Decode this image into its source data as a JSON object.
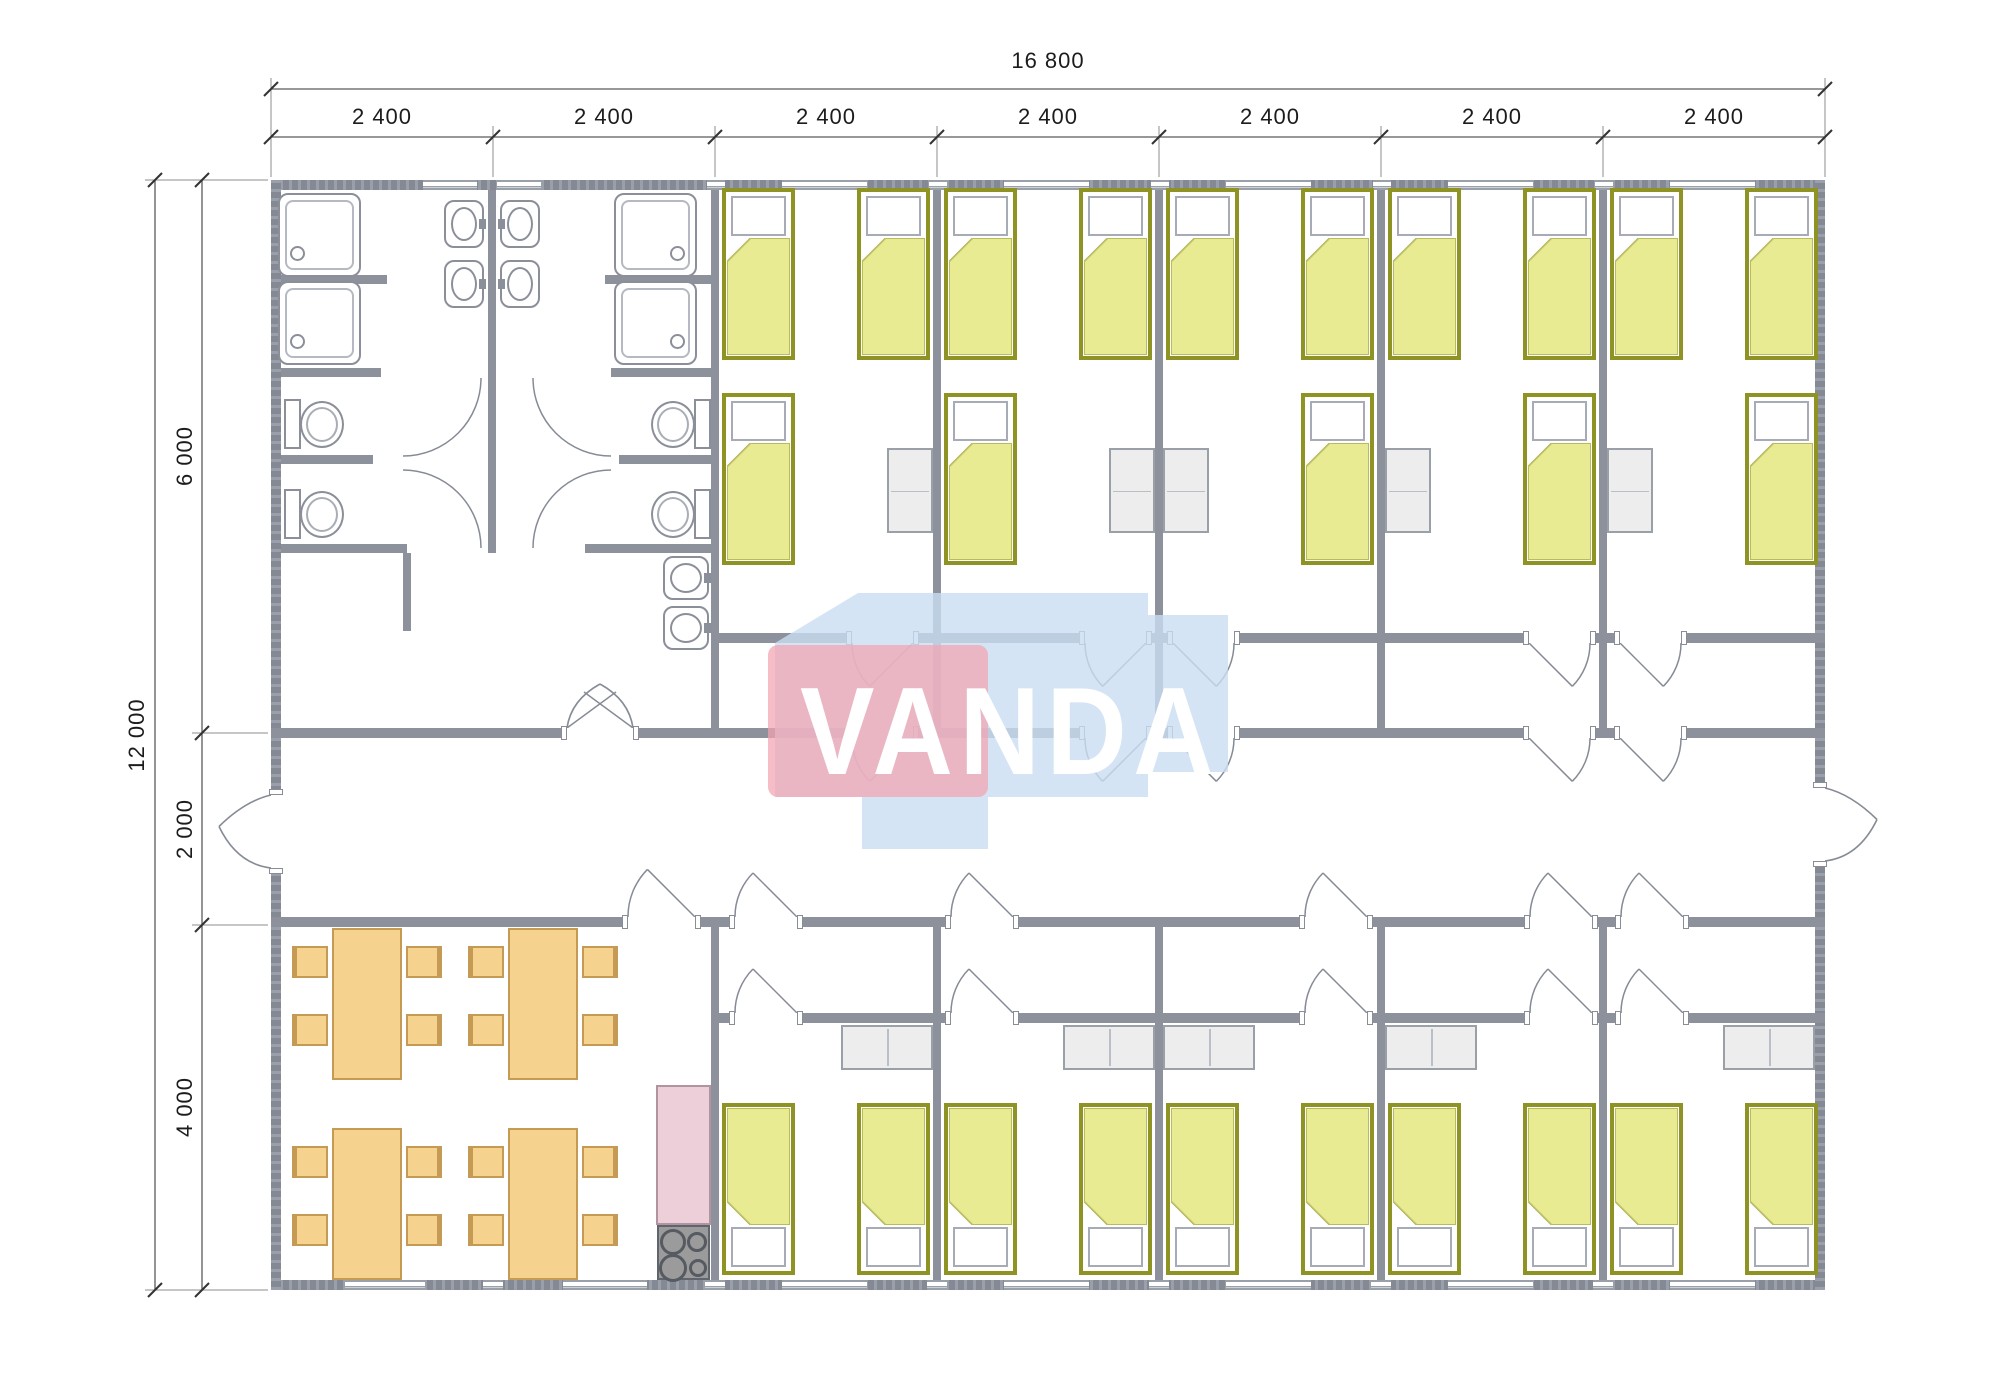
{
  "canvas": {
    "width": 2000,
    "height": 1391,
    "background": "#ffffff"
  },
  "watermark": {
    "text": "VANDA",
    "pink_color": "rgba(242,164,178,0.72)",
    "blue_color": "rgba(201,221,241,0.80)",
    "text_color": "#ffffff",
    "blue_polygon": "775,643 858,593 1148,593 1148,615 1228,615 1228,772 1148,772 1148,797 988,797 988,849 862,849 862,797 775,797"
  },
  "dimensions": {
    "top_total": "16 800",
    "top_modules": [
      "2 400",
      "2 400",
      "2 400",
      "2 400",
      "2 400",
      "2 400",
      "2 400"
    ],
    "left_total": "12 000",
    "left_segments": [
      "6 000",
      "2 000",
      "4 000"
    ],
    "geometry": {
      "lines": [
        [
          271,
          89,
          1825,
          89
        ],
        [
          271,
          137,
          1825,
          137
        ],
        [
          155,
          180,
          155,
          1290
        ],
        [
          202,
          180,
          202,
          1290
        ]
      ],
      "ticks": [
        [
          271,
          89
        ],
        [
          1825,
          89
        ],
        [
          271,
          137
        ],
        [
          493,
          137
        ],
        [
          715,
          137
        ],
        [
          937,
          137
        ],
        [
          1159,
          137
        ],
        [
          1381,
          137
        ],
        [
          1603,
          137
        ],
        [
          1825,
          137
        ],
        [
          155,
          180
        ],
        [
          155,
          1290
        ],
        [
          202,
          180
        ],
        [
          202,
          733
        ],
        [
          202,
          925
        ],
        [
          202,
          1290
        ]
      ],
      "extensions": [
        [
          271,
          78,
          271,
          177
        ],
        [
          1825,
          78,
          1825,
          177
        ],
        [
          493,
          126,
          493,
          177
        ],
        [
          715,
          126,
          715,
          177
        ],
        [
          937,
          126,
          937,
          177
        ],
        [
          1159,
          126,
          1159,
          177
        ],
        [
          1381,
          126,
          1381,
          177
        ],
        [
          1603,
          126,
          1603,
          177
        ],
        [
          145,
          180,
          268,
          180
        ],
        [
          145,
          1290,
          268,
          1290
        ],
        [
          192,
          733,
          268,
          733
        ],
        [
          192,
          925,
          268,
          925
        ]
      ],
      "module_label_centers": [
        382,
        604,
        826,
        1048,
        1270,
        1492,
        1714
      ],
      "module_label_y": 104,
      "total_label": {
        "cx": 1048,
        "y": 48
      },
      "left_total_center": {
        "cx": 137,
        "cy": 735
      },
      "left_segment_centers": [
        456,
        829,
        1107
      ],
      "left_segment_x": 185
    }
  },
  "plan": {
    "colors": {
      "wall": "#8d919c",
      "bed_border": "#8e9323",
      "bed_fill": "#e9eb92",
      "furniture_wood": "#f5d28e",
      "wood_border": "#c49a55",
      "wardrobe": "#ededed",
      "counter": "#eccfd8",
      "stove": "#9b9b9b",
      "fixture_stroke": "#8a8f99",
      "dim_color": "#1c1c1c"
    },
    "walls": [
      [
        271,
        180,
        1554,
        10,
        "hx"
      ],
      [
        271,
        1280,
        1554,
        10,
        "hx"
      ],
      [
        271,
        180,
        10,
        1110,
        "hy"
      ],
      [
        1815,
        180,
        10,
        1110,
        "hy"
      ],
      [
        271,
        728,
        1554,
        10,
        ""
      ],
      [
        271,
        917,
        1554,
        10,
        ""
      ],
      [
        715,
        633,
        1110,
        10,
        ""
      ],
      [
        715,
        1013,
        1110,
        10,
        ""
      ],
      [
        711,
        190,
        8,
        538,
        ""
      ],
      [
        711,
        927,
        8,
        353,
        ""
      ],
      [
        933,
        190,
        8,
        548,
        ""
      ],
      [
        1155,
        190,
        8,
        548,
        ""
      ],
      [
        1377,
        190,
        8,
        548,
        ""
      ],
      [
        1599,
        190,
        8,
        548,
        ""
      ],
      [
        933,
        927,
        8,
        353,
        ""
      ],
      [
        1155,
        927,
        8,
        353,
        ""
      ],
      [
        1377,
        927,
        8,
        353,
        ""
      ],
      [
        1599,
        927,
        8,
        353,
        ""
      ],
      [
        488,
        190,
        8,
        363,
        ""
      ],
      [
        281,
        275,
        106,
        9,
        ""
      ],
      [
        281,
        368,
        100,
        9,
        ""
      ],
      [
        281,
        455,
        92,
        9,
        ""
      ],
      [
        281,
        544,
        126,
        9,
        ""
      ],
      [
        605,
        275,
        106,
        9,
        ""
      ],
      [
        611,
        368,
        100,
        9,
        ""
      ],
      [
        619,
        455,
        92,
        9,
        ""
      ],
      [
        585,
        544,
        126,
        9,
        ""
      ],
      [
        403,
        553,
        8,
        78,
        ""
      ]
    ],
    "windows": [
      [
        423,
        180,
        54
      ],
      [
        497,
        180,
        44
      ],
      [
        782,
        180,
        85
      ],
      [
        1004,
        180,
        85
      ],
      [
        1226,
        180,
        85
      ],
      [
        1448,
        180,
        85
      ],
      [
        1670,
        180,
        85
      ],
      [
        707,
        180,
        18
      ],
      [
        929,
        180,
        18
      ],
      [
        1151,
        180,
        18
      ],
      [
        1373,
        180,
        18
      ],
      [
        1595,
        180,
        18
      ],
      [
        345,
        1280,
        80
      ],
      [
        563,
        1280,
        84
      ],
      [
        782,
        1280,
        85
      ],
      [
        1004,
        1280,
        85
      ],
      [
        1226,
        1280,
        85
      ],
      [
        1448,
        1280,
        85
      ],
      [
        1670,
        1280,
        85
      ],
      [
        483,
        1280,
        20
      ],
      [
        705,
        1280,
        20
      ],
      [
        927,
        1280,
        20
      ],
      [
        1149,
        1280,
        20
      ],
      [
        1371,
        1280,
        20
      ],
      [
        1593,
        1280,
        20
      ]
    ],
    "doors": [
      {
        "type": "dbl",
        "x": 567,
        "y": 728,
        "w": 66
      },
      {
        "type": "q",
        "x": 628,
        "y": 917,
        "w": 67,
        "dir": -1,
        "hinge": "r"
      },
      {
        "type": "q",
        "x": 852,
        "y": 633,
        "w": 61,
        "dir": 1,
        "hinge": "r"
      },
      {
        "type": "q",
        "x": 1085,
        "y": 633,
        "w": 61,
        "dir": 1,
        "hinge": "r"
      },
      {
        "type": "q",
        "x": 1173,
        "y": 633,
        "w": 61,
        "dir": 1,
        "hinge": "l"
      },
      {
        "type": "q",
        "x": 1529,
        "y": 633,
        "w": 61,
        "dir": 1,
        "hinge": "l"
      },
      {
        "type": "q",
        "x": 1620,
        "y": 633,
        "w": 61,
        "dir": 1,
        "hinge": "l"
      },
      {
        "type": "q",
        "x": 852,
        "y": 728,
        "w": 61,
        "dir": 1,
        "hinge": "r"
      },
      {
        "type": "q",
        "x": 1085,
        "y": 728,
        "w": 61,
        "dir": 1,
        "hinge": "r"
      },
      {
        "type": "q",
        "x": 1173,
        "y": 728,
        "w": 61,
        "dir": 1,
        "hinge": "l"
      },
      {
        "type": "q",
        "x": 1529,
        "y": 728,
        "w": 61,
        "dir": 1,
        "hinge": "l"
      },
      {
        "type": "q",
        "x": 1620,
        "y": 728,
        "w": 61,
        "dir": 1,
        "hinge": "l"
      },
      {
        "type": "q",
        "x": 735,
        "y": 917,
        "w": 62,
        "dir": -1,
        "hinge": "r"
      },
      {
        "type": "q",
        "x": 951,
        "y": 917,
        "w": 62,
        "dir": -1,
        "hinge": "r"
      },
      {
        "type": "q",
        "x": 1305,
        "y": 917,
        "w": 62,
        "dir": -1,
        "hinge": "r"
      },
      {
        "type": "q",
        "x": 1530,
        "y": 917,
        "w": 62,
        "dir": -1,
        "hinge": "r"
      },
      {
        "type": "q",
        "x": 1621,
        "y": 917,
        "w": 62,
        "dir": -1,
        "hinge": "r"
      },
      {
        "type": "q",
        "x": 735,
        "y": 1013,
        "w": 62,
        "dir": -1,
        "hinge": "r"
      },
      {
        "type": "q",
        "x": 951,
        "y": 1013,
        "w": 62,
        "dir": -1,
        "hinge": "r"
      },
      {
        "type": "q",
        "x": 1305,
        "y": 1013,
        "w": 62,
        "dir": -1,
        "hinge": "r"
      },
      {
        "type": "q",
        "x": 1530,
        "y": 1013,
        "w": 62,
        "dir": -1,
        "hinge": "r"
      },
      {
        "type": "q",
        "x": 1621,
        "y": 1013,
        "w": 62,
        "dir": -1,
        "hinge": "r"
      },
      {
        "type": "entry",
        "side": "l",
        "y": 795,
        "w": 73
      },
      {
        "type": "entry",
        "side": "r",
        "y": 788,
        "w": 73
      }
    ],
    "extra_arcs": [
      "M403,456 A78,78 0 0 0 481,378",
      "M533,378 A78,78 0 0 0 611,456",
      "M481,548 A78,78 0 0 0 403,470",
      "M611,470 A78,78 0 0 0 533,548"
    ],
    "beds": {
      "size": [
        73,
        172
      ],
      "north": [
        [
          722,
          188
        ],
        [
          857,
          188
        ],
        [
          944,
          188
        ],
        [
          1079,
          188
        ],
        [
          1166,
          188
        ],
        [
          1301,
          188
        ],
        [
          1388,
          188
        ],
        [
          1523,
          188
        ],
        [
          1610,
          188
        ],
        [
          1745,
          188
        ],
        [
          722,
          393
        ],
        [
          944,
          393
        ],
        [
          1301,
          393
        ],
        [
          1523,
          393
        ],
        [
          1745,
          393
        ]
      ],
      "south": [
        [
          722,
          1103
        ],
        [
          857,
          1103
        ],
        [
          944,
          1103
        ],
        [
          1079,
          1103
        ],
        [
          1166,
          1103
        ],
        [
          1301,
          1103
        ],
        [
          1388,
          1103
        ],
        [
          1523,
          1103
        ],
        [
          1610,
          1103
        ],
        [
          1745,
          1103
        ]
      ]
    },
    "wardrobes": {
      "vertical": {
        "size": [
          46,
          85
        ],
        "pos": [
          [
            887,
            448
          ],
          [
            1109,
            448
          ],
          [
            1163,
            448
          ],
          [
            1385,
            448
          ],
          [
            1607,
            448
          ]
        ]
      },
      "horizontal": {
        "size": [
          92,
          45
        ],
        "pos": [
          [
            841,
            1025
          ],
          [
            1063,
            1025
          ],
          [
            1163,
            1025
          ],
          [
            1385,
            1025
          ],
          [
            1723,
            1025
          ]
        ]
      }
    },
    "showers": {
      "size": [
        83,
        84
      ],
      "pos": [
        [
          278,
          193,
          "bl"
        ],
        [
          278,
          281,
          "bl"
        ],
        [
          614,
          193,
          "br"
        ],
        [
          614,
          281,
          "br"
        ]
      ]
    },
    "toilets": [
      [
        284,
        396,
        "r"
      ],
      [
        284,
        486,
        "r"
      ],
      [
        649,
        396,
        "l"
      ],
      [
        649,
        486,
        "l"
      ]
    ],
    "sinks": [
      [
        444,
        200,
        40,
        48,
        "r"
      ],
      [
        444,
        260,
        40,
        48,
        "r"
      ],
      [
        500,
        200,
        40,
        48,
        "l"
      ],
      [
        500,
        260,
        40,
        48,
        "l"
      ],
      [
        663,
        556,
        46,
        44,
        "r"
      ],
      [
        663,
        606,
        46,
        44,
        "r"
      ]
    ],
    "dining": {
      "table_size": [
        70,
        152
      ],
      "tables": [
        [
          332,
          928
        ],
        [
          508,
          928
        ],
        [
          332,
          1128
        ],
        [
          508,
          1128
        ]
      ],
      "chair_size": [
        36,
        32
      ],
      "chair_offsets": [
        [
          -40,
          18,
          "bl"
        ],
        [
          -40,
          86,
          "bl"
        ],
        [
          74,
          18,
          "br"
        ],
        [
          74,
          86,
          "br"
        ]
      ]
    },
    "kitchen": {
      "counter": [
        656,
        1085,
        55,
        140
      ],
      "stove": [
        657,
        1225,
        53,
        55
      ],
      "burners": [
        [
          671,
          1240,
          13
        ],
        [
          695,
          1240,
          10
        ],
        [
          671,
          1266,
          14
        ],
        [
          696,
          1266,
          9
        ]
      ]
    }
  }
}
